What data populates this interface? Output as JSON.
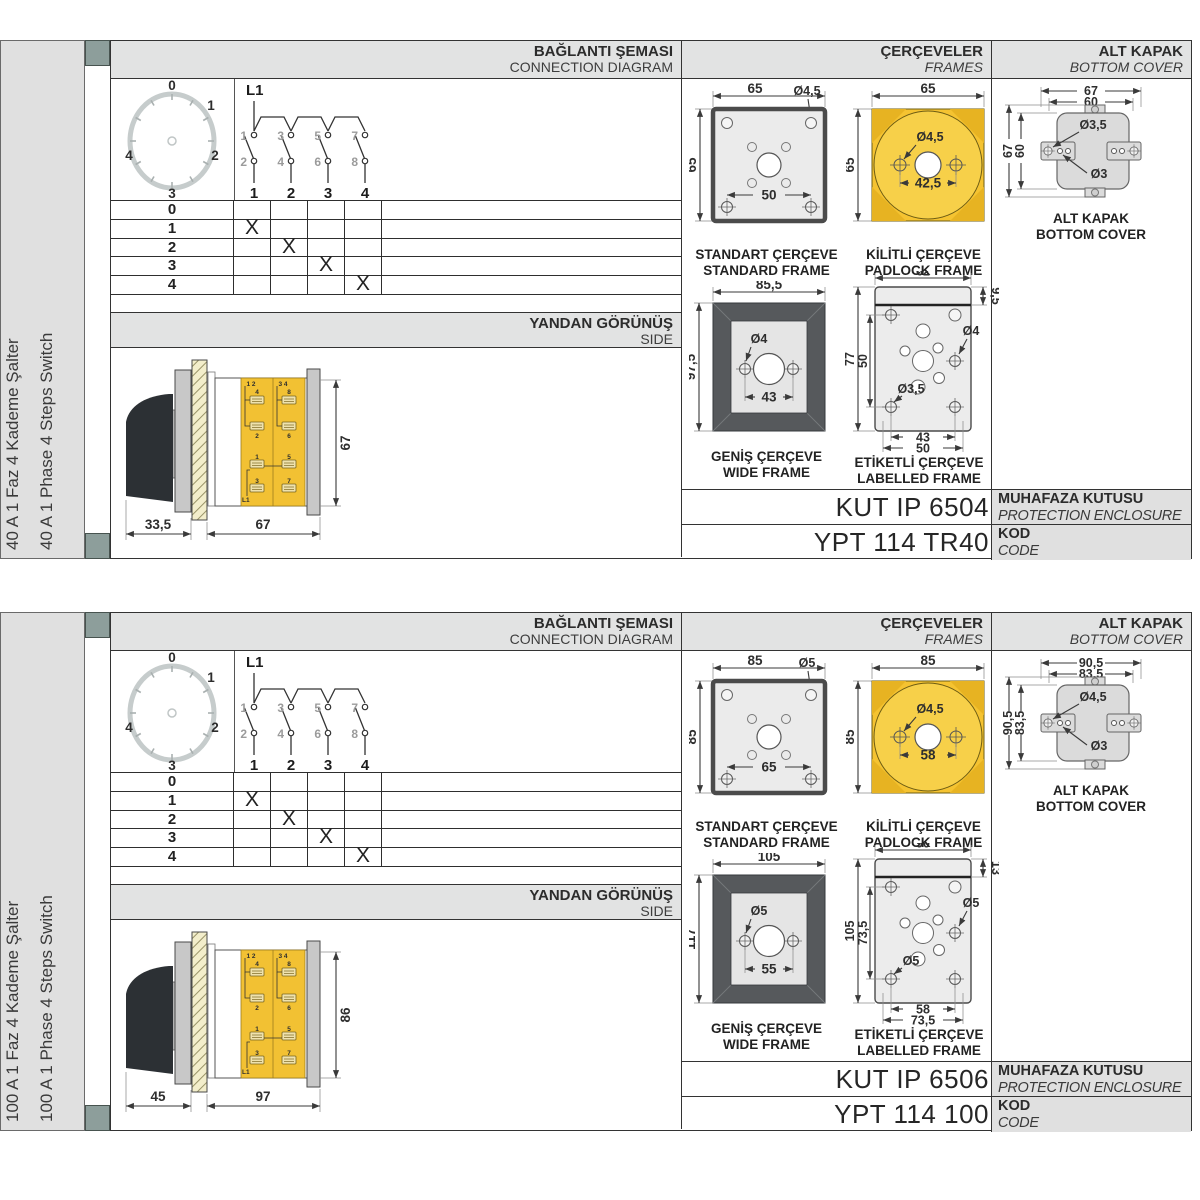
{
  "shared": {
    "headers": {
      "connection_tr": "BAĞLANTI ŞEMASI",
      "connection_en": "CONNECTION DIAGRAM",
      "frames_tr": "ÇERÇEVELER",
      "frames_en": "FRAMES",
      "cover_tr": "ALT KAPAK",
      "cover_en": "BOTTOM COVER",
      "side_tr": "YANDAN GÖRÜNÜŞ",
      "side_en": "SIDE"
    },
    "dial": {
      "positions": [
        "0",
        "1",
        "2",
        "3",
        "4"
      ]
    },
    "schematic": {
      "line_label": "L1",
      "top_contacts": [
        "1",
        "3",
        "5",
        "7"
      ],
      "bottom_contacts": [
        "2",
        "4",
        "6",
        "8"
      ],
      "terminals": [
        "1",
        "2",
        "3",
        "4"
      ]
    },
    "table": {
      "steps": [
        "0",
        "1",
        "2",
        "3",
        "4"
      ],
      "mark": "X"
    },
    "side_labels": {
      "c1_top": "1 2",
      "c2_top": "3 4",
      "b1": "4",
      "b2": "2",
      "b3": "8",
      "b4": "6",
      "b5": "1",
      "b6": "3",
      "b7": "5",
      "b8": "7",
      "line": "L1"
    },
    "captions": {
      "standard_tr": "STANDART ÇERÇEVE",
      "standard_en": "STANDARD FRAME",
      "padlock_tr": "KİLİTLİ ÇERÇEVE",
      "padlock_en": "PADLOCK FRAME",
      "wide_tr": "GENİŞ ÇERÇEVE",
      "wide_en": "WIDE FRAME",
      "labelled_tr": "ETİKETLİ ÇERÇEVE",
      "labelled_en": "LABELLED FRAME",
      "cover_tr": "ALT KAPAK",
      "cover_en": "BOTTOM COVER"
    },
    "code_labels": {
      "enclosure_tr": "MUHAFAZA KUTUSU",
      "enclosure_en": "PROTECTION ENCLOSURE",
      "code_tr": "KOD",
      "code_en": "CODE"
    },
    "colors": {
      "accent_yellow": "#f5c331",
      "light_yellow": "#f7d049",
      "frame_dark": "#56595c",
      "band_gray": "#e2e3e3",
      "tab_green": "#8d9e9b",
      "plate_gray": "#c8c8c8"
    }
  },
  "products": [
    {
      "title_tr": "40 A 1 Faz 4 Kademe Şalter",
      "title_en": "40 A 1 Phase 4 Steps Switch",
      "side": {
        "dim_front": "33,5",
        "dim_depth": "67",
        "dim_height": "67"
      },
      "standard": {
        "width": "65",
        "height": "65",
        "hole": "Ø4,5",
        "spacing": "50"
      },
      "padlock": {
        "width": "65",
        "height": "65",
        "hole": "Ø4,5",
        "spacing": "42,5"
      },
      "wide": {
        "width": "85,5",
        "height": "97,5",
        "hole": "Ø4",
        "spacing": "43"
      },
      "labelled": {
        "width": "62",
        "strip": "9,5",
        "height": "77",
        "inner_height": "50",
        "hole_side": "Ø4",
        "hole_corner": "Ø3,5",
        "spacing_inner": "43",
        "spacing_outer": "50"
      },
      "cover": {
        "width_outer": "67",
        "width_inner": "60",
        "height_outer": "67",
        "height_inner": "60",
        "hole_large": "Ø3,5",
        "hole_small": "Ø3"
      },
      "enclosure_code": "KUT IP 6504",
      "product_code": "YPT 114 TR40"
    },
    {
      "title_tr": "100 A 1 Faz 4 Kademe Şalter",
      "title_en": "100 A 1 Phase 4 Steps Switch",
      "side": {
        "dim_front": "45",
        "dim_depth": "97",
        "dim_height": "86"
      },
      "standard": {
        "width": "85",
        "height": "85",
        "hole": "Ø5",
        "spacing": "65"
      },
      "padlock": {
        "width": "85",
        "height": "85",
        "hole": "Ø4,5",
        "spacing": "58"
      },
      "wide": {
        "width": "105",
        "height": "117",
        "hole": "Ø5",
        "spacing": "55"
      },
      "labelled": {
        "width": "90",
        "strip": "13",
        "height": "105",
        "inner_height": "73,5",
        "hole_side": "Ø5",
        "hole_corner": "Ø5",
        "spacing_inner": "58",
        "spacing_outer": "73,5"
      },
      "cover": {
        "width_outer": "90,5",
        "width_inner": "83,5",
        "height_outer": "90,5",
        "height_inner": "83,5",
        "hole_large": "Ø4,5",
        "hole_small": "Ø3"
      },
      "enclosure_code": "KUT IP 6506",
      "product_code": "YPT 114 100"
    }
  ]
}
